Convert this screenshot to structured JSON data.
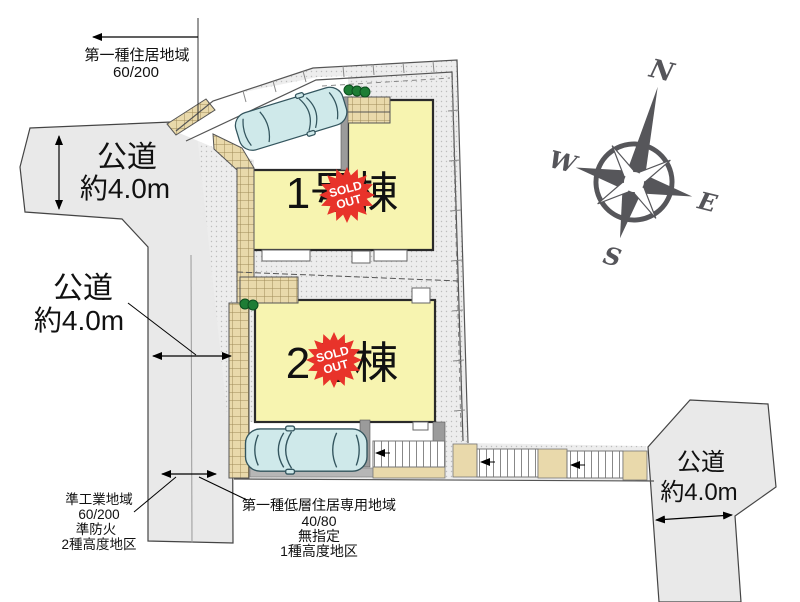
{
  "zones": {
    "north": {
      "name": "第一種住居地域",
      "ratio": "60/200"
    },
    "southwest": {
      "name": "準工業地域",
      "ratio": "60/200",
      "fireproof": "準防火",
      "height_district": "2種高度地区"
    },
    "south": {
      "name": "第一種低層住居専用地域",
      "ratio": "40/80",
      "fireproof": "無指定",
      "height_district": "1種高度地区"
    }
  },
  "roads": {
    "west_upper": {
      "type": "公道",
      "width": "約4.0m"
    },
    "west_lower": {
      "type": "公道",
      "width": "約4.0m"
    },
    "southeast": {
      "type": "公道",
      "width": "約4.0m"
    }
  },
  "buildings": [
    {
      "label": "1号棟",
      "status": "SOLD OUT"
    },
    {
      "label": "2号棟",
      "status": "SOLD OUT"
    }
  ],
  "sold": {
    "line1": "SOLD",
    "line2": "OUT"
  },
  "compass": {
    "n": "N",
    "e": "E",
    "s": "S",
    "w": "W"
  },
  "colors": {
    "building": "#f7f4b0",
    "sold_badge": "#e8332a",
    "road": "#e9e9e9",
    "tile": "#e9d9ab",
    "car": "#cfe9ea",
    "bush": "#1e7d35",
    "compass": "#56565a"
  }
}
